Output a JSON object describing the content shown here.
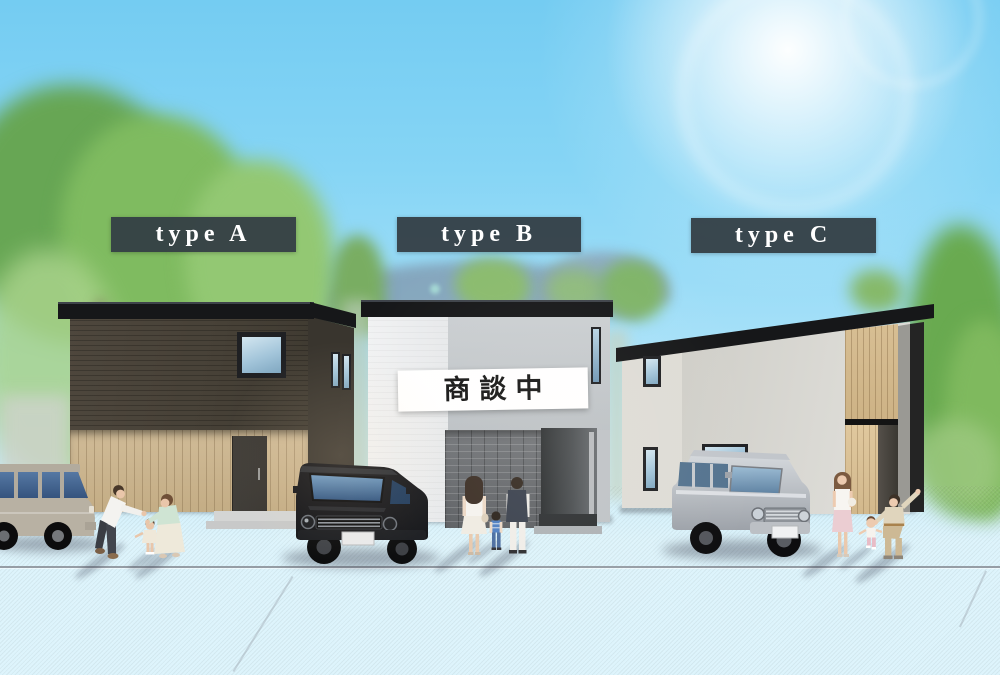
{
  "scene": {
    "houses": [
      {
        "id": "house-a",
        "label": "type A"
      },
      {
        "id": "house-b",
        "label": "type B",
        "status_banner": "商談中"
      },
      {
        "id": "house-c",
        "label": "type C"
      }
    ],
    "colors": {
      "label_background": "#343e45",
      "label_text": "#ffffff",
      "banner_background": "#ffffff",
      "banner_text": "#161616",
      "sky_top": "#74ccf2",
      "sky_horizon": "#ddf4fc",
      "roof": "#161719",
      "house_a_upper_siding": "#4a443b",
      "house_a_wood_siding": "#c9b38d",
      "house_b_white_wall": "#edeff0",
      "house_b_gray_wall": "#c5c9cc",
      "house_b_brick": "#686b6e",
      "house_c_wall": "#d5d4cf",
      "house_c_wood_accent": "#d3b98d",
      "pavement": "#cbced4",
      "road": "#b0b5bf",
      "suv_black": "#141519",
      "suv_silver": "#c8ccd1",
      "suv_beige": "#b8b1a3"
    }
  }
}
